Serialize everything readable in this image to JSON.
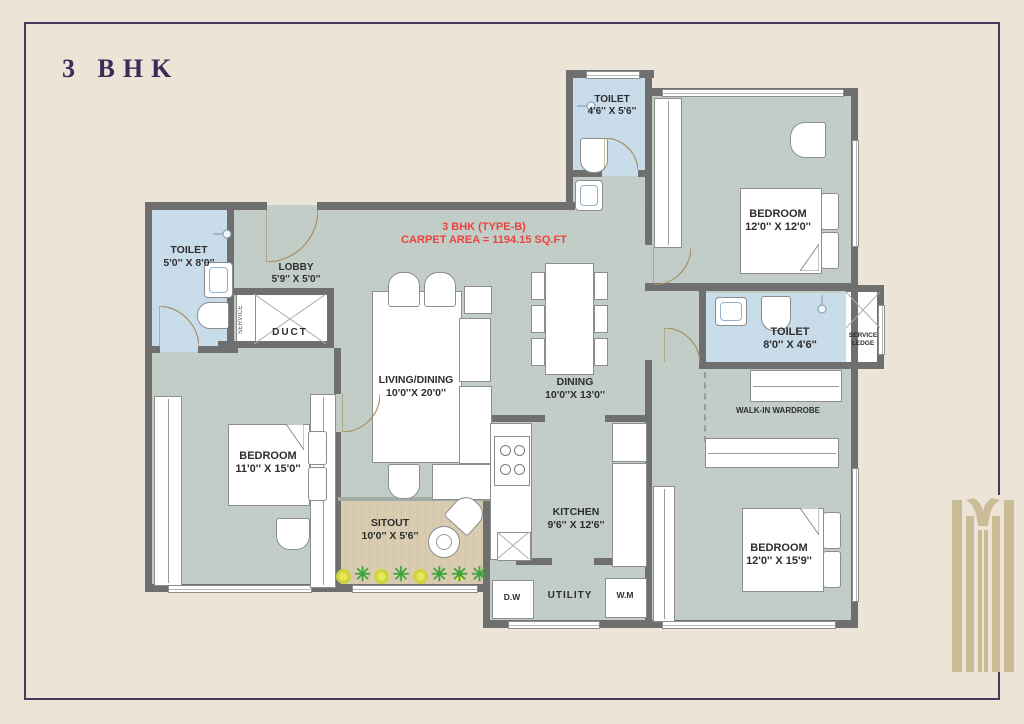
{
  "title": "3 BHK",
  "annotation": {
    "line1": "3 BHK (TYPE-B)",
    "line2": "CARPET AREA = 1194.15 SQ.FT"
  },
  "rooms": {
    "toilet_top": {
      "name": "TOILET",
      "dim": "4'6'' X 5'6''"
    },
    "bedroom_top_right": {
      "name": "BEDROOM",
      "dim": "12'0'' X 12'0''"
    },
    "toilet_left": {
      "name": "TOILET",
      "dim": "5'0'' X 8'0''"
    },
    "lobby": {
      "name": "LOBBY",
      "dim": "5'9'' X 5'0''"
    },
    "duct": {
      "name": "DUCT"
    },
    "service_strip": {
      "name": "SERVICE"
    },
    "living_dining": {
      "name": "LIVING/DINING",
      "dim": "10'0''X 20'0''"
    },
    "dining": {
      "name": "DINING",
      "dim": "10'0''X 13'0''"
    },
    "toilet_right": {
      "name": "TOILET",
      "dim": "8'0'' X 4'6''"
    },
    "service_ledge": {
      "line1": "SERVICE",
      "line2": "LEDGE"
    },
    "walk_in_wardrobe": {
      "name": "WALK-IN WARDROBE"
    },
    "bedroom_left": {
      "name": "BEDROOM",
      "dim": "11'0'' X 15'0''"
    },
    "sitout": {
      "name": "SITOUT",
      "dim": "10'0'' X 5'6''"
    },
    "kitchen": {
      "name": "KITCHEN",
      "dim": "9'6'' X 12'6''"
    },
    "utility": {
      "name": "UTILITY"
    },
    "appliances": {
      "dishwasher": "D.W",
      "washing_machine": "W.M"
    },
    "bedroom_bottom_right": {
      "name": "BEDROOM",
      "dim": "12'0'' X 15'9''"
    }
  },
  "colors": {
    "background": "#ece4d7",
    "frame": "#4a3a60",
    "title_text": "#3d2a56",
    "wall": "#6f6f70",
    "floor": "#c2cdc8",
    "toilet_floor": "#c8dcea",
    "sitout_floor": "#d9ccb1",
    "annotation_text": "#e8453e",
    "logo": "#cbbc97"
  }
}
